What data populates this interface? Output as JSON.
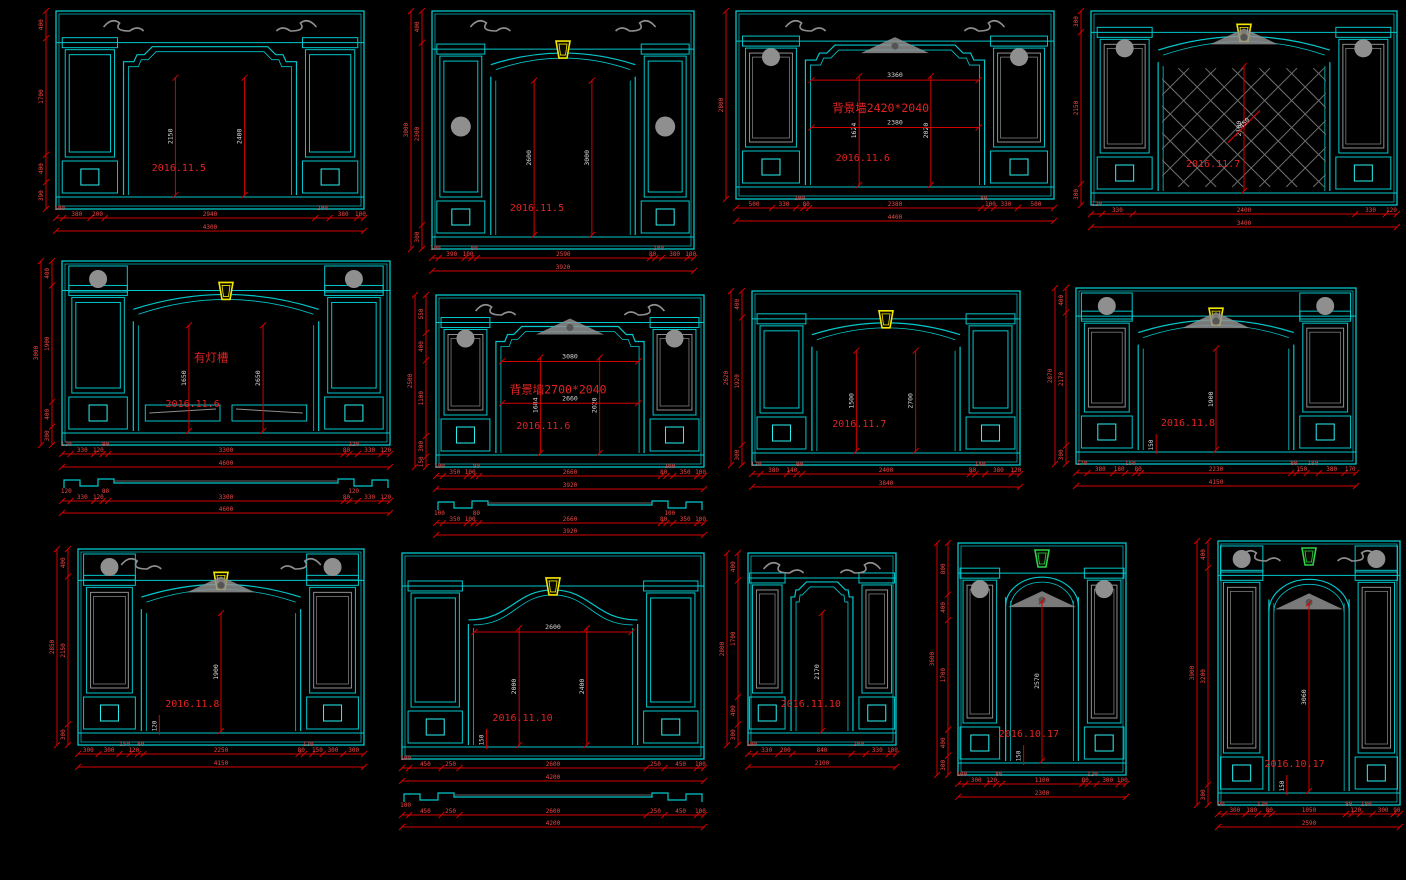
{
  "canvas": {
    "width": 1406,
    "height": 880,
    "background": "#000000"
  },
  "palette": {
    "line_cyan": "#00c8cc",
    "line_cyan_bright": "#2cf2f2",
    "dim_red_line": "#d40000",
    "dim_text_red": "#f04545",
    "inner_dim_text": "#d8d8d8",
    "date_text_red": "#e32222",
    "ornament_gray": "#8f8f8f",
    "lattice_gray": "#6f6f6f",
    "keystone_yellow": "#f5e800",
    "keystone_green": "#2bd24b"
  },
  "drawings": [
    {
      "id": "d1",
      "date": "2016.11.5",
      "annotation": "",
      "arch": "shoulder",
      "keystone": "",
      "lattice": false,
      "crest": false,
      "corner_scrolls": true,
      "medallions": "none",
      "gray_shaft": false,
      "bottom_panels": false,
      "section_below": false,
      "layout": {
        "x": 28,
        "y": 8,
        "w": 342,
        "h": 248
      },
      "dims": {
        "bottom": [
          "100",
          "380",
          "200",
          "2940",
          "200",
          "380",
          "100"
        ],
        "bottom_total": "4300",
        "left": [
          "400",
          "1700",
          "400",
          "390"
        ],
        "left_total": "",
        "inner_v": [
          "2150",
          "2400"
        ],
        "inner_w": [],
        "diag": ""
      }
    },
    {
      "id": "d2",
      "date": "2016.11.5",
      "annotation": "",
      "arch": "segment",
      "keystone": "yellow",
      "lattice": false,
      "crest": false,
      "corner_scrolls": true,
      "medallions": "shaft",
      "gray_shaft": false,
      "bottom_panels": false,
      "section_below": false,
      "layout": {
        "x": 394,
        "y": 8,
        "w": 306,
        "h": 288
      },
      "dims": {
        "bottom": [
          "100",
          "390",
          "100",
          "80",
          "2590",
          "80",
          "100",
          "380",
          "100"
        ],
        "bottom_total": "3920",
        "left": [
          "400",
          "2300",
          "300"
        ],
        "left_total": "3000",
        "inner_v": [
          "2600",
          "3000"
        ],
        "inner_w": [],
        "diag": ""
      }
    },
    {
      "id": "d3",
      "date": "2016.11.6",
      "annotation": "背景墙2420*2040",
      "arch": "shoulder",
      "keystone": "",
      "lattice": false,
      "crest": true,
      "corner_scrolls": true,
      "medallions": "capital",
      "gray_shaft": true,
      "bottom_panels": false,
      "section_below": false,
      "layout": {
        "x": 708,
        "y": 8,
        "w": 352,
        "h": 238
      },
      "dims": {
        "bottom": [
          "500",
          "330",
          "100",
          "80",
          "2380",
          "80",
          "100",
          "330",
          "500"
        ],
        "bottom_total": "4400",
        "left": [
          "2800"
        ],
        "left_total": "",
        "inner_v": [
          "1624",
          "2020"
        ],
        "inner_w": [
          "3360",
          "2380"
        ],
        "diag": ""
      }
    },
    {
      "id": "d4",
      "date": "2016.11.7",
      "annotation": "",
      "arch": "segment",
      "keystone": "yellow",
      "lattice": true,
      "crest": true,
      "corner_scrolls": false,
      "medallions": "capital",
      "gray_shaft": true,
      "bottom_panels": false,
      "section_below": false,
      "layout": {
        "x": 1063,
        "y": 8,
        "w": 340,
        "h": 244
      },
      "dims": {
        "bottom": [
          "120",
          "330",
          "2400",
          "330",
          "120"
        ],
        "bottom_total": "3400",
        "left": [
          "300",
          "2150",
          "300"
        ],
        "left_total": "",
        "inner_v": [
          "2100"
        ],
        "inner_w": [],
        "diag": "450"
      }
    },
    {
      "id": "d5",
      "date": "2016.11.6",
      "annotation": "有灯槽",
      "arch": "segment",
      "keystone": "yellow",
      "lattice": false,
      "crest": false,
      "corner_scrolls": false,
      "medallions": "corner",
      "gray_shaft": false,
      "bottom_panels": true,
      "section_below": true,
      "layout": {
        "x": 24,
        "y": 258,
        "w": 372,
        "h": 270
      },
      "dims": {
        "bottom": [
          "120",
          "330",
          "120",
          "80",
          "3300",
          "80",
          "120",
          "330",
          "120"
        ],
        "bottom_total": "4600",
        "left": [
          "400",
          "1900",
          "400",
          "300"
        ],
        "left_total": "3000",
        "inner_v": [
          "1650",
          "2650"
        ],
        "inner_w": [],
        "diag": "",
        "section": [
          "120",
          "330",
          "120",
          "80",
          "3300",
          "80",
          "120",
          "330",
          "120"
        ],
        "section_total": "4600"
      }
    },
    {
      "id": "d6",
      "date": "2016.11.6",
      "annotation": "背景墙2700*2040",
      "arch": "shoulder",
      "keystone": "",
      "lattice": false,
      "crest": true,
      "corner_scrolls": true,
      "medallions": "capital",
      "gray_shaft": true,
      "bottom_panels": false,
      "section_below": true,
      "layout": {
        "x": 398,
        "y": 292,
        "w": 312,
        "h": 258
      },
      "dims": {
        "bottom": [
          "100",
          "350",
          "100",
          "80",
          "2660",
          "80",
          "100",
          "350",
          "100"
        ],
        "bottom_total": "3920",
        "left": [
          "550",
          "400",
          "1100",
          "300",
          "150"
        ],
        "left_total": "2500",
        "inner_v": [
          "1684",
          "2020"
        ],
        "inner_w": [
          "3080",
          "2660"
        ],
        "diag": "",
        "section": [
          "100",
          "350",
          "100",
          "80",
          "2660",
          "80",
          "100",
          "350",
          "100"
        ],
        "section_total": "3920"
      }
    },
    {
      "id": "d7",
      "date": "2016.11.7",
      "annotation": "",
      "arch": "segment",
      "keystone": "yellow",
      "lattice": false,
      "crest": false,
      "corner_scrolls": false,
      "medallions": "none",
      "gray_shaft": false,
      "bottom_panels": false,
      "section_below": false,
      "layout": {
        "x": 714,
        "y": 288,
        "w": 312,
        "h": 224
      },
      "dims": {
        "bottom": [
          "120",
          "380",
          "140",
          "80",
          "2400",
          "80",
          "140",
          "380",
          "120"
        ],
        "bottom_total": "3840",
        "left": [
          "400",
          "1920",
          "300"
        ],
        "left_total": "2620",
        "inner_v": [
          "1500",
          "2700"
        ],
        "inner_w": [],
        "diag": ""
      }
    },
    {
      "id": "d8",
      "date": "2016.11.8",
      "annotation": "",
      "arch": "segment",
      "keystone": "yellow",
      "lattice": false,
      "crest": true,
      "corner_scrolls": false,
      "medallions": "corner",
      "gray_shaft": true,
      "bottom_panels": false,
      "section_below": false,
      "layout": {
        "x": 1038,
        "y": 285,
        "w": 324,
        "h": 226
      },
      "dims": {
        "bottom": [
          "170",
          "380",
          "180",
          "150",
          "80",
          "2230",
          "80",
          "150",
          "180",
          "380",
          "170"
        ],
        "bottom_total": "4150",
        "left": [
          "400",
          "2170",
          "300"
        ],
        "left_total": "2870",
        "inner_v": [
          "1900",
          "150"
        ],
        "inner_w": [],
        "diag": ""
      }
    },
    {
      "id": "d9",
      "date": "2016.11.8",
      "annotation": "",
      "arch": "segment",
      "keystone": "yellow",
      "lattice": false,
      "crest": true,
      "corner_scrolls": true,
      "medallions": "corner",
      "gray_shaft": true,
      "bottom_panels": false,
      "section_below": false,
      "layout": {
        "x": 40,
        "y": 546,
        "w": 330,
        "h": 246
      },
      "dims": {
        "bottom": [
          "300",
          "300",
          "150",
          "120",
          "80",
          "2250",
          "80",
          "120",
          "150",
          "300",
          "300"
        ],
        "bottom_total": "4150",
        "left": [
          "400",
          "2150",
          "300"
        ],
        "left_total": "2850",
        "inner_v": [
          "1900",
          "120"
        ],
        "inner_w": [],
        "diag": ""
      }
    },
    {
      "id": "d10",
      "date": "2016.11.10",
      "annotation": "",
      "arch": "ogee",
      "keystone": "yellow",
      "lattice": false,
      "crest": false,
      "corner_scrolls": false,
      "medallions": "none",
      "gray_shaft": false,
      "bottom_panels": false,
      "section_below": true,
      "layout": {
        "x": 388,
        "y": 550,
        "w": 322,
        "h": 292
      },
      "dims": {
        "bottom": [
          "100",
          "450",
          "250",
          "2600",
          "250",
          "450",
          "100"
        ],
        "bottom_total": "4200",
        "left": [],
        "left_total": "",
        "inner_v": [
          "2000",
          "2400",
          "150"
        ],
        "inner_w": [
          "2600"
        ],
        "diag": "",
        "section": [
          "100",
          "450",
          "250",
          "2600",
          "250",
          "450",
          "100"
        ],
        "section_total": "4200"
      }
    },
    {
      "id": "d11",
      "date": "2016.11.10",
      "annotation": "",
      "arch": "shoulder",
      "keystone": "",
      "lattice": false,
      "crest": false,
      "corner_scrolls": true,
      "medallions": "none",
      "gray_shaft": true,
      "bottom_panels": false,
      "section_below": false,
      "layout": {
        "x": 710,
        "y": 550,
        "w": 192,
        "h": 242
      },
      "dims": {
        "bottom": [
          "100",
          "330",
          "200",
          "840",
          "200",
          "330",
          "100"
        ],
        "bottom_total": "2100",
        "left": [
          "400",
          "1700",
          "400",
          "300"
        ],
        "left_total": "2800",
        "inner_v": [
          "2170"
        ],
        "inner_w": [],
        "diag": ""
      }
    },
    {
      "id": "d12",
      "date": "2016.10.17",
      "annotation": "",
      "arch": "round",
      "keystone": "green",
      "lattice": false,
      "crest": true,
      "corner_scrolls": false,
      "medallions": "capital",
      "gray_shaft": true,
      "bottom_panels": false,
      "section_below": false,
      "layout": {
        "x": 920,
        "y": 540,
        "w": 212,
        "h": 282
      },
      "dims": {
        "bottom": [
          "100",
          "300",
          "120",
          "80",
          "1100",
          "80",
          "120",
          "300",
          "100"
        ],
        "bottom_total": "2300",
        "left": [
          "800",
          "400",
          "1700",
          "400",
          "300"
        ],
        "left_total": "3600",
        "inner_v": [
          "2570",
          "150"
        ],
        "inner_w": [],
        "diag": ""
      }
    },
    {
      "id": "d13",
      "date": "2016.10.17",
      "annotation": "",
      "arch": "round",
      "keystone": "green",
      "lattice": false,
      "crest": true,
      "corner_scrolls": true,
      "medallions": "corner",
      "gray_shaft": true,
      "bottom_panels": false,
      "section_below": false,
      "layout": {
        "x": 1180,
        "y": 538,
        "w": 226,
        "h": 314
      },
      "dims": {
        "bottom": [
          "90",
          "300",
          "180",
          "120",
          "80",
          "1050",
          "80",
          "120",
          "180",
          "300",
          "90"
        ],
        "bottom_total": "2590",
        "left": [
          "400",
          "3200",
          "300"
        ],
        "left_total": "3900",
        "inner_v": [
          "3060",
          "150"
        ],
        "inner_w": [],
        "diag": ""
      }
    }
  ]
}
